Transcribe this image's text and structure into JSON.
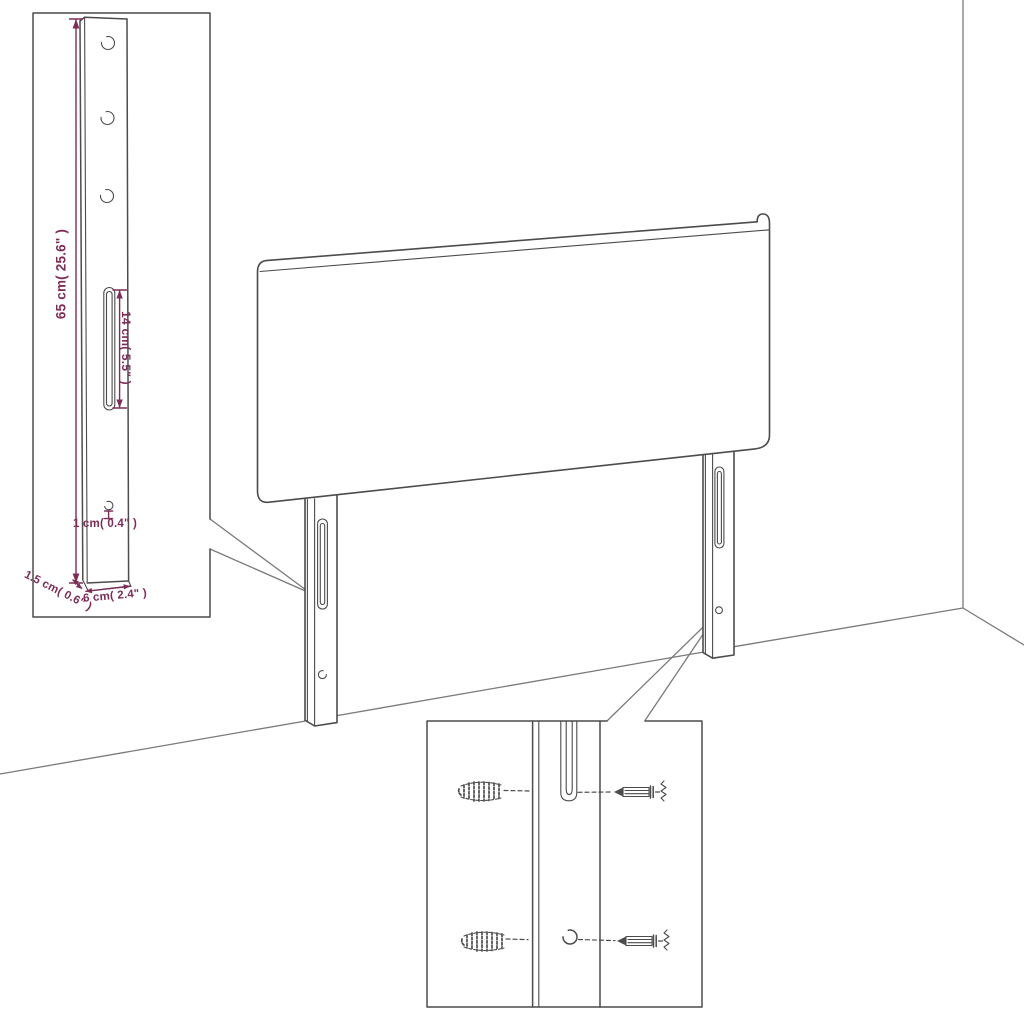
{
  "colors": {
    "line_gray": "#4c4c4c",
    "line_light": "#7a7a7a",
    "dimension_purple": "#7c2e59",
    "background": "#ffffff"
  },
  "leg_detail": {
    "dim_height": "65 cm( 25.6\" )",
    "dim_slot_length": "14 cm( 5.5\" )",
    "dim_hole": "1 cm( 0.4\" )",
    "dim_depth": "1.5 cm( 0.6\" )",
    "dim_width": "6 cm( 2.4\" )"
  },
  "mounting_detail": {
    "parts": [
      "wall-plug-icon",
      "screw-icon",
      "keyhole-slot",
      "screw-hole"
    ]
  }
}
